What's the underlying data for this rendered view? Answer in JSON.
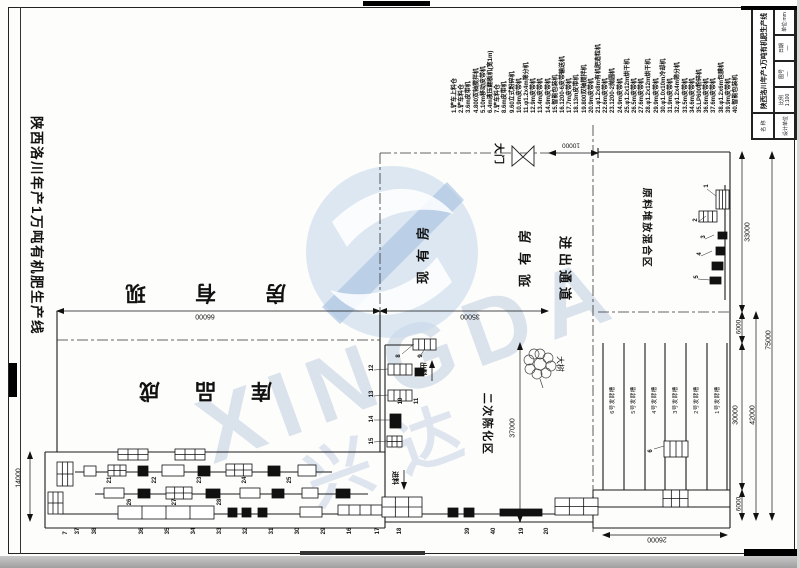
{
  "drawing": {
    "side_title": "陕西洛川年产1万吨有机肥生产线",
    "watermark": {
      "latin": "XINGDA",
      "cn": "兴达"
    }
  },
  "equipment_list": [
    "1.铲车上料仓",
    "2.铲车料仓",
    "3.6m皮带机",
    "4.800双轴搅拌机",
    "5.10m移动皮带机",
    "6.4m液压翻板机(宽1m)",
    "7.铲车料仓",
    "8.6m皮带机",
    "9.60立式粉碎机",
    "10.9m皮带机",
    "11.φ1.2x4m筛分机",
    "12.9m皮带机",
    "13.4m皮带机",
    "14.9m皮带机",
    "15.智能包装机",
    "16.1200-6皮带输送机",
    "17.7m皮带机",
    "18.13m皮带机",
    "19.800双轴搅拌机",
    "20.9m皮带机",
    "21.φ1.2x8m有机肥造粒机",
    "22.6m皮带机",
    "23.1200-2抛圆机",
    "24.9m皮带机",
    "25.φ1.2x12m烘干机",
    "26.5m皮带机",
    "27.6m皮带机",
    "28.φ1.2x12m烘干机",
    "29.9m皮带机",
    "30.φ1.0x10m冷却机",
    "31.9m皮带机",
    "32.φ1.2x4m筛分机",
    "33.5m皮带机",
    "34.6m皮带机",
    "35.LP600粉碎机",
    "36.6m皮带机",
    "37.6m皮带机",
    "38.φ1.2x6m包膜机",
    "39.9m皮带机",
    "40.智能包装机"
  ],
  "areas": {
    "existing_room_h": "现有房",
    "finished_store": "成品库",
    "existing_room_v": "现有房",
    "gate": "大门",
    "passage": "进出通道",
    "secondary_aging": "二次陈化区",
    "raw_material": "原料堆放混合区",
    "tree": "大树",
    "feed_in": "进料",
    "discharge": "出料"
  },
  "troughs": [
    "6号发酵槽",
    "5号发酵槽",
    "4号发酵槽",
    "3号发酵槽",
    "2号发酵槽",
    "1号发酵槽"
  ],
  "dimensions": [
    {
      "id": "d66000",
      "value": "66000"
    },
    {
      "id": "d35000",
      "value": "35000"
    },
    {
      "id": "d10000",
      "value": "10000"
    },
    {
      "id": "d14000",
      "value": "14000"
    },
    {
      "id": "d37000",
      "value": "37000"
    },
    {
      "id": "d33000",
      "value": "33000"
    },
    {
      "id": "d6000a",
      "value": "6000"
    },
    {
      "id": "d30000",
      "value": "30000"
    },
    {
      "id": "d42000",
      "value": "42000"
    },
    {
      "id": "d6000b",
      "value": "6000"
    },
    {
      "id": "d75000",
      "value": "75000"
    },
    {
      "id": "d26000",
      "value": "26000"
    }
  ],
  "machine_tags": [
    "1",
    "2",
    "3",
    "4",
    "5",
    "6",
    "7",
    "8",
    "9",
    "10",
    "11",
    "12",
    "13",
    "14",
    "15",
    "16",
    "17",
    "18",
    "19",
    "20",
    "21",
    "22",
    "23",
    "24",
    "25",
    "26",
    "27",
    "28",
    "29",
    "30",
    "31",
    "32",
    "33",
    "34",
    "35",
    "36",
    "37",
    "38",
    "39",
    "40"
  ],
  "title_block": {
    "project": "陕西洛川年产1万吨有机肥生产线",
    "name_label": "名 称",
    "designer_label": "设计单位",
    "scale_label": "比例",
    "scale_value": "1:100",
    "sheet_label": "图号",
    "sheet_value": "—",
    "date_label": "日期",
    "date_value": "—",
    "unit_note": "单位:mm"
  }
}
